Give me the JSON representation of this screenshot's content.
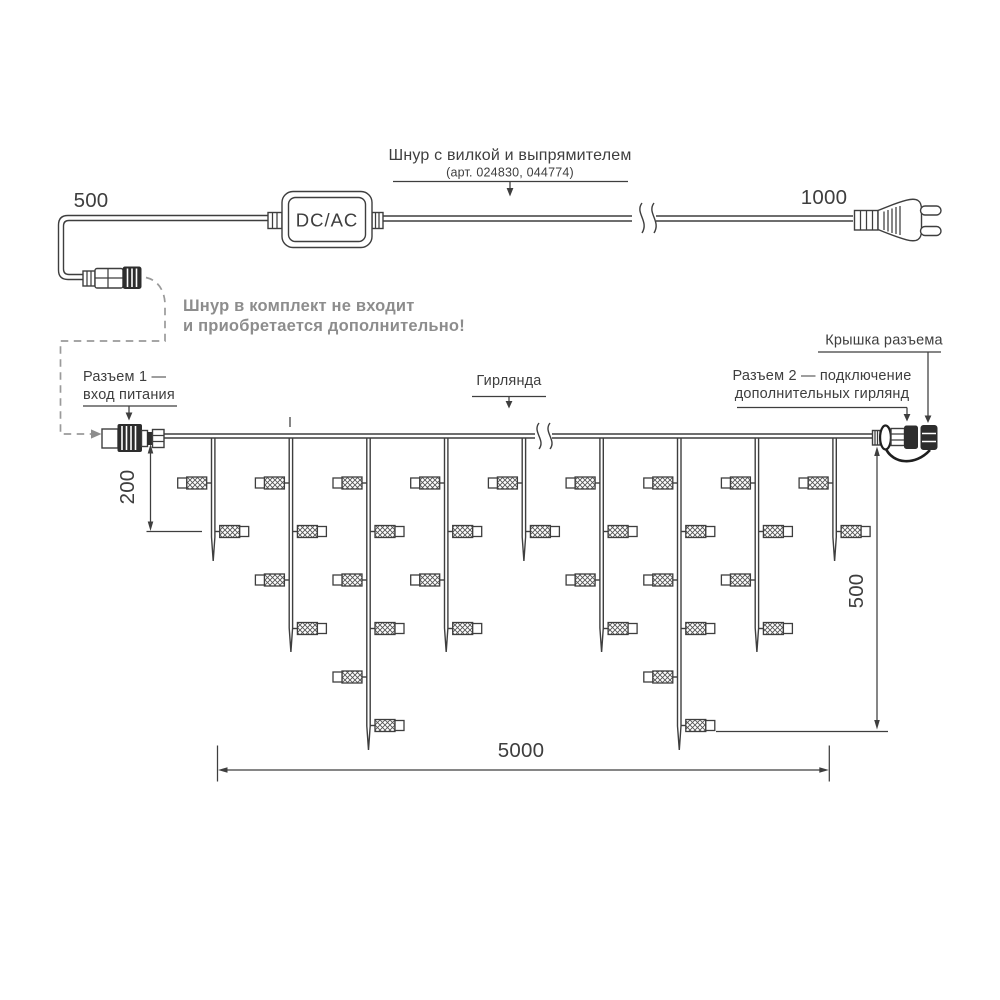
{
  "colors": {
    "line": "#3e3e3e",
    "text": "#3e3e3e",
    "muted_text": "#8d8d8d",
    "dashed_line": "#9a9a9a",
    "dark_fill": "#2d2d2d"
  },
  "power_cord": {
    "title_line1": "Шнур с вилкой и выпрямителем",
    "title_line2": "(арт. 024830, 044774)",
    "adapter_label": "DC/AC",
    "dim_cord_to_connector": "500",
    "dim_cord_to_plug": "1000",
    "note_line1": "Шнур в комплект не входит",
    "note_line2": "и приобретается дополнительно!"
  },
  "garland": {
    "label": "Гирлянда",
    "connector1_line1": "Разъем 1 —",
    "connector1_line2": "вход питания",
    "connector2_line1": "Разъем 2 — подключение",
    "connector2_line2": "дополнительных гирлянд",
    "cap_label": "Крышка разъема",
    "drops_lamp_counts": [
      2,
      4,
      6,
      4,
      2,
      4,
      6,
      4,
      2
    ],
    "dim_first_lamp_drop": "200",
    "dim_max_drop": "500",
    "dim_length": "5000"
  }
}
